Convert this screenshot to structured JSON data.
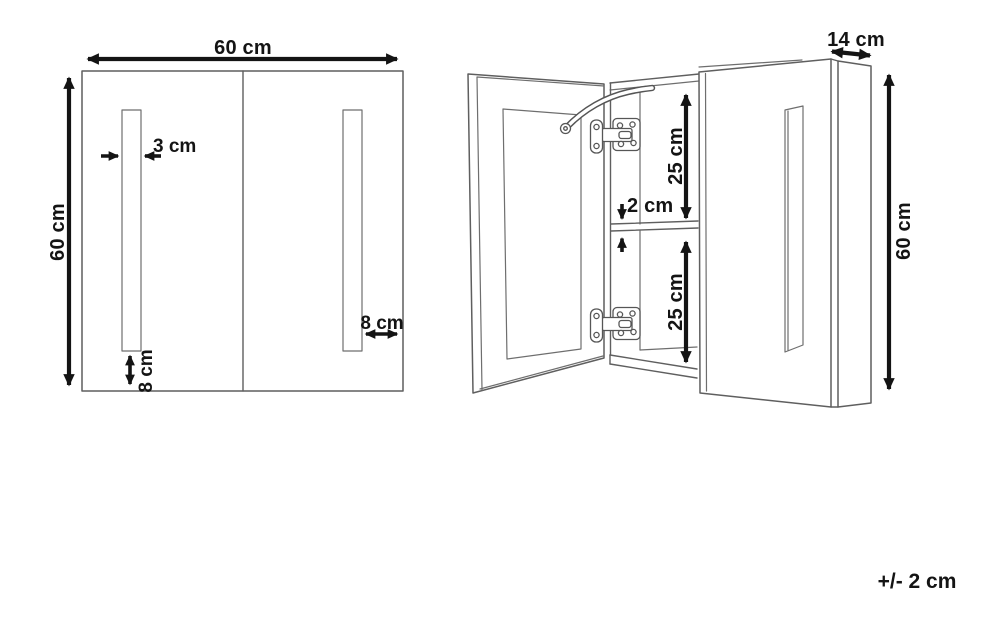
{
  "document": {
    "type": "cabinet dimension drawing",
    "tolerance_note": "+/- 2 cm"
  },
  "front_view": {
    "width_label": "60 cm",
    "height_label": "60 cm",
    "strip_width_label": "3 cm",
    "strip_bottom_offset_label": "8 cm",
    "strip_side_offset_label": "8 cm"
  },
  "open_view": {
    "depth_label": "14 cm",
    "height_label": "60 cm",
    "upper_compartment_label": "25 cm",
    "shelf_thickness_label": "2 cm",
    "lower_compartment_label": "25 cm"
  },
  "colors": {
    "background": "#ffffff",
    "drawing_line": "#5f5f5f",
    "dimension": "#141414"
  }
}
